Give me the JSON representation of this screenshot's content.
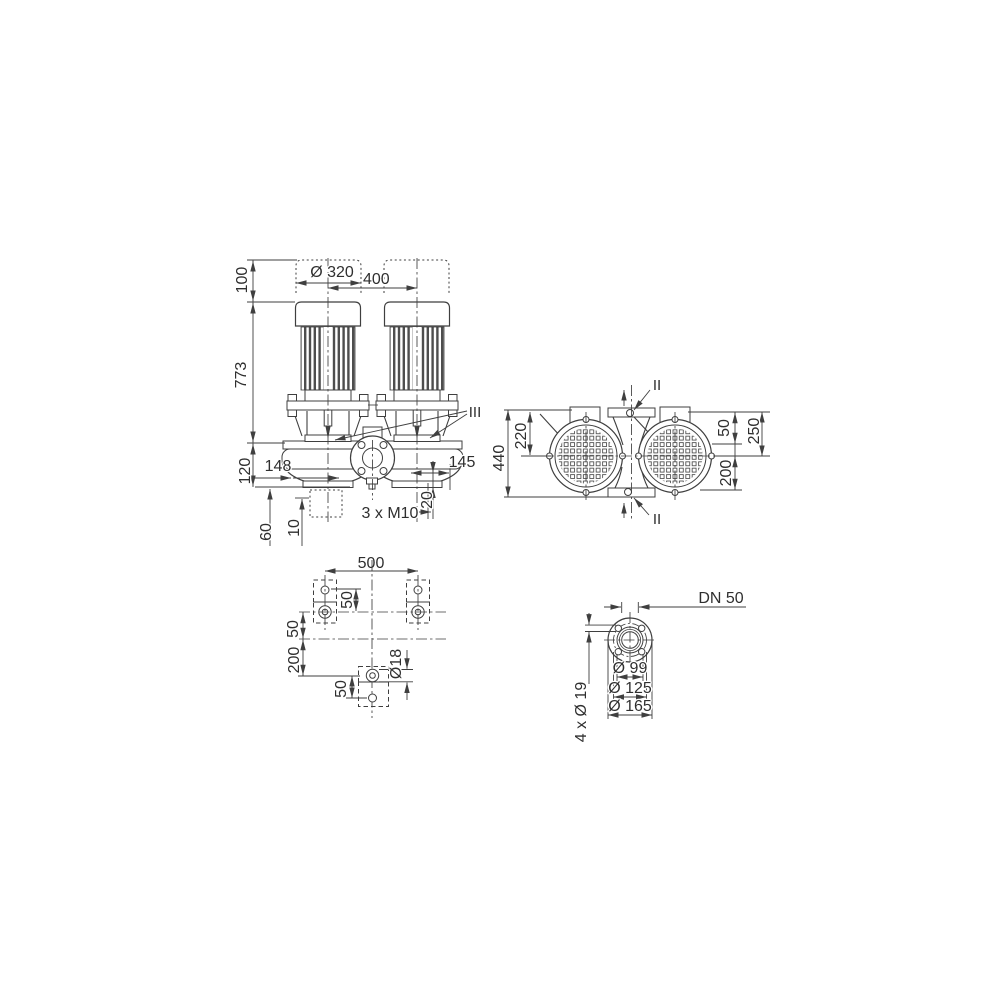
{
  "drawing": {
    "background": "#ffffff",
    "line_color": "#3f3f3f",
    "text_color": "#2f2f2f",
    "front_view": {
      "cap_height": "100",
      "motor_diameter": "Ø 320",
      "motor_spacing": "400",
      "total_height": "773",
      "base_height": "120",
      "left_offset": "148",
      "right_offset": "145",
      "foot_thickness": "20",
      "tapped_holes": "3 x M10",
      "anchor_depth": "60",
      "grout_thickness": "10",
      "section_mark": "III"
    },
    "top_view": {
      "overall_width": "440",
      "motor_axis_offset": "220",
      "port_offset": "50",
      "overall_depth": "250",
      "axis_to_edge": "200",
      "section_mark_top": "II",
      "section_mark_bottom": "II"
    },
    "foundation_view": {
      "bolt_spacing": "500",
      "upper_hole_offset": "50",
      "axis_offset": "50",
      "lower_axis_offset": "200",
      "lower_hole_offset": "50",
      "hole_diameter": "Ø18"
    },
    "flange_view": {
      "nominal_diameter": "DN 50",
      "pilot_diameter": "Ø 99",
      "bolt_circle_diameter": "Ø 125",
      "outer_diameter": "Ø 165",
      "bolt_holes": "4 x Ø 19"
    }
  }
}
